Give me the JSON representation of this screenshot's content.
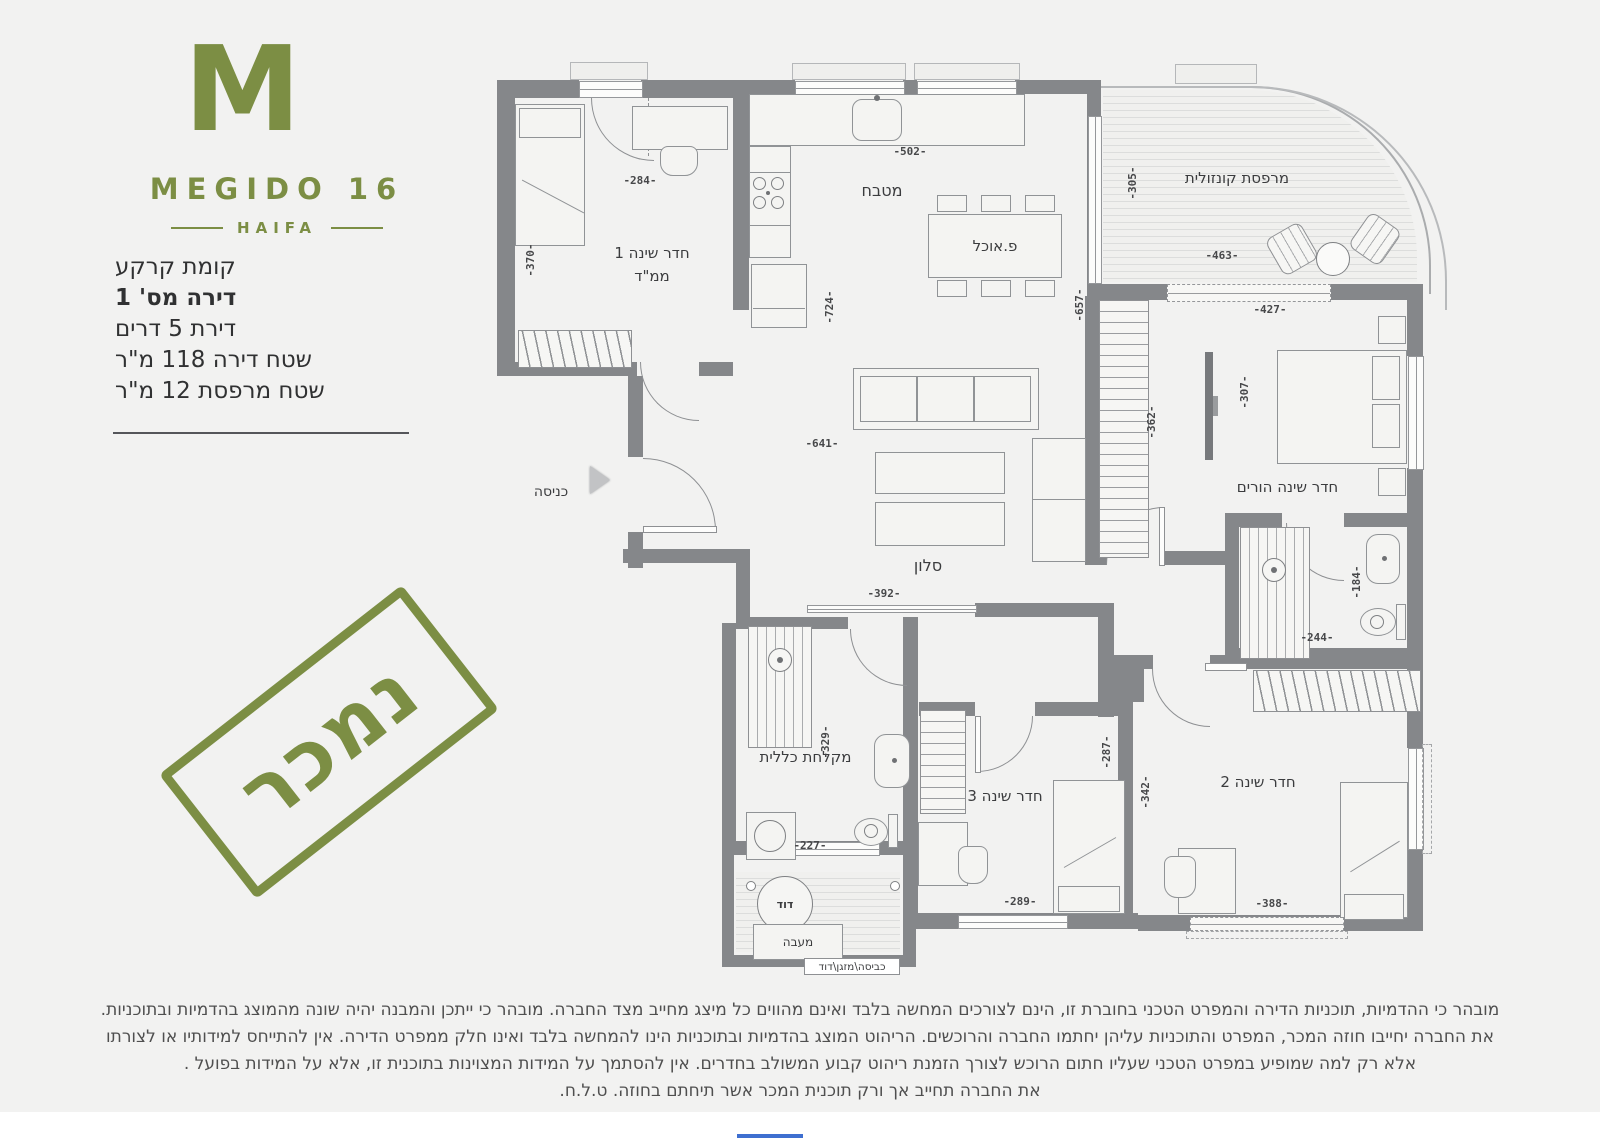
{
  "brand": {
    "mark": "M",
    "name": "MEGIDO 16",
    "city": "HAIFA"
  },
  "apartment": {
    "floor": "קומת קרקע",
    "unit": "דירה מס' 1",
    "rooms": "דירת 5 דרים",
    "area": "שטח דירה 118 מ\"ר",
    "balcony_area": "שטח מרפסת 12 מ\"ר"
  },
  "stamp": "נמכר",
  "rooms": {
    "bedroom1": "חדר שינה 1",
    "bedroom1_sub": "ממ\"ד",
    "kitchen": "מטבח",
    "dining": "פ.אוכל",
    "balcony": "מרפסת קונזולית",
    "master": "חדר שינה הורים",
    "living": "סלון",
    "entrance": "כניסה",
    "bath": "מקלחת כללית",
    "bedroom3": "חדר שינה 3",
    "bedroom2": "חדר שינה 2",
    "boiler": "דוד",
    "condenser": "מעבה",
    "service": "כביסה\\מזגן\\דוד"
  },
  "dims": {
    "d284": "-284-",
    "d370": "-370-",
    "d502": "-502-",
    "d724": "-724-",
    "d657": "-657-",
    "d305": "-305-",
    "d463": "-463-",
    "d427": "-427-",
    "d362": "-362-",
    "d307": "-307-",
    "d641": "-641-",
    "d392": "-392-",
    "d184": "-184-",
    "d244": "-244-",
    "d329": "-329-",
    "d227": "-227-",
    "d287": "-287-",
    "d342": "-342-",
    "d289": "-289-",
    "d388": "-388-"
  },
  "disclaimer": {
    "line1": "מובהר כי ההדמיות, תוכניות הדירה והמפרט הטכני בחוברת זו, הינם לצורכים המחשה בלבד ואינם מהווים כל מיצג מחייב מצד החברה.  מובהר כי ייתכן והמבנה יהיה שונה מהמוצג בהדמיות ובתוכניות.",
    "line2": "את החברה יחייבו חוזה המכר, המפרט והתוכניות עליהן יחתמו החברה והרוכשים. הריהוט המוצג בהדמיות ובתוכניות הינו להמחשה בלבד ואינו חלק ממפרט הדירה. אין להתייחס למידותיו או לצורתו",
    "line3": "אלא רק למה שמופיע במפרט הטכני שעליו חתום הרוכש לצורך הזמנת ריהוט קבוע המשולב בחדרים. אין להסתמך על המידות המצוינות בתוכנית זו, אלא על המידות בפועל .",
    "line4": "את החברה תחייב אך ורק תוכנית המכר אשר תיחתם בחוזה. ט.ל.ח."
  },
  "colors": {
    "brand": "#7c8e44",
    "wall": "#85878a"
  }
}
